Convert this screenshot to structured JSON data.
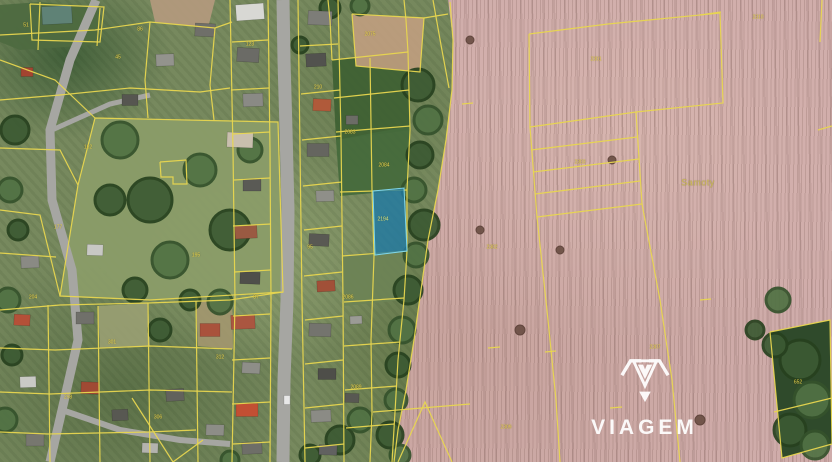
{
  "brand": {
    "name": "VIAGEM"
  },
  "map": {
    "type": "cadastral-aerial",
    "line_color": "#e8d64f",
    "road_color": "#a6a6a2",
    "field_area_label": "Samoty",
    "highlighted_parcel": {
      "label": "2194",
      "points": "373,191 404,188 407,251 375,255",
      "fill": "#1e7aa6",
      "fill_opacity": 0.78,
      "stroke": "#7fd6ea"
    },
    "labels": [
      {
        "x": 140,
        "y": 30,
        "t": "86"
      },
      {
        "x": 250,
        "y": 45,
        "t": "123"
      },
      {
        "x": 318,
        "y": 88,
        "t": "210"
      },
      {
        "x": 196,
        "y": 256,
        "t": "195"
      },
      {
        "x": 88,
        "y": 148,
        "t": "162"
      },
      {
        "x": 58,
        "y": 228,
        "t": "177"
      },
      {
        "x": 33,
        "y": 298,
        "t": "204"
      },
      {
        "x": 112,
        "y": 343,
        "t": "301"
      },
      {
        "x": 68,
        "y": 398,
        "t": "298"
      },
      {
        "x": 158,
        "y": 418,
        "t": "306"
      },
      {
        "x": 220,
        "y": 358,
        "t": "312"
      },
      {
        "x": 256,
        "y": 298,
        "t": "87"
      },
      {
        "x": 310,
        "y": 248,
        "t": "95"
      },
      {
        "x": 350,
        "y": 133,
        "t": "2083"
      },
      {
        "x": 384,
        "y": 166,
        "t": "2084"
      },
      {
        "x": 383,
        "y": 220,
        "t": "2194",
        "cls": "hl"
      },
      {
        "x": 348,
        "y": 298,
        "t": "2086"
      },
      {
        "x": 356,
        "y": 388,
        "t": "2089"
      },
      {
        "x": 596,
        "y": 60,
        "t": "2301"
      },
      {
        "x": 492,
        "y": 248,
        "t": "2302"
      },
      {
        "x": 580,
        "y": 163,
        "t": "2303"
      },
      {
        "x": 758,
        "y": 18,
        "t": "2310"
      },
      {
        "x": 655,
        "y": 348,
        "t": "2307"
      },
      {
        "x": 506,
        "y": 428,
        "t": "2309"
      },
      {
        "x": 798,
        "y": 383,
        "t": "652"
      },
      {
        "x": 118,
        "y": 58,
        "t": "45"
      },
      {
        "x": 26,
        "y": 26,
        "t": "51"
      },
      {
        "x": 370,
        "y": 35,
        "t": "2075"
      },
      {
        "x": 698,
        "y": 183,
        "t": "Samoty",
        "cls": "area"
      }
    ],
    "greens": [
      {
        "p": "95,118 278,122 283,292 150,300 60,296 78,185",
        "c": "#8a9c68"
      },
      {
        "p": "0,5 40,2 100,8 95,45 20,50 0,42",
        "c": "#4e6a40"
      },
      {
        "p": "332,60 408,52 410,130 336,140",
        "c": "#3f6134"
      },
      {
        "p": "336,140 410,126 407,190 340,196",
        "c": "#466a3c"
      },
      {
        "p": "342,256 407,251 404,300 344,306",
        "c": "#6d8355"
      }
    ],
    "dirt": [
      {
        "p": "352,14 424,18 420,72 356,66",
        "c": "#c19f80"
      },
      {
        "p": "150,0 215,0 208,28 155,22",
        "c": "#b59a7e"
      },
      {
        "p": "98,306 148,303 150,346 100,348",
        "c": "#9aa073"
      },
      {
        "p": "196,301 232,300 233,349 198,346",
        "c": "#a3976f"
      }
    ],
    "forest": [
      {
        "p": "770,332 830,320 832,444 782,458",
        "c": "#2f4a2b"
      }
    ],
    "roads": [
      {
        "p": "283,0 284,60 286,130 288,210 287,300 284,380 283,462",
        "w": 13
      },
      {
        "p": "96,0 70,60 50,130 52,200 72,270 78,340 62,410 50,462",
        "w": 9
      },
      {
        "p": "52,130 110,104 150,95",
        "w": 5
      },
      {
        "p": "62,410 120,430 180,440 230,444",
        "w": 6
      }
    ],
    "trees": [
      [
        418,
        85,
        16,
        0
      ],
      [
        428,
        120,
        14,
        1
      ],
      [
        420,
        155,
        13,
        0
      ],
      [
        414,
        190,
        12,
        1
      ],
      [
        424,
        225,
        15,
        0
      ],
      [
        416,
        255,
        12,
        1
      ],
      [
        408,
        290,
        14,
        0
      ],
      [
        402,
        330,
        13,
        1
      ],
      [
        398,
        365,
        12,
        0
      ],
      [
        396,
        400,
        11,
        1
      ],
      [
        390,
        435,
        13,
        0
      ],
      [
        400,
        455,
        10,
        1
      ],
      [
        330,
        8,
        10,
        0
      ],
      [
        360,
        6,
        9,
        1
      ],
      [
        300,
        45,
        8,
        0
      ],
      [
        120,
        140,
        18,
        1
      ],
      [
        150,
        200,
        22,
        0
      ],
      [
        200,
        170,
        16,
        1
      ],
      [
        230,
        230,
        20,
        0
      ],
      [
        170,
        260,
        18,
        1
      ],
      [
        110,
        200,
        15,
        0
      ],
      [
        250,
        150,
        12,
        1
      ],
      [
        135,
        290,
        12,
        0
      ],
      [
        15,
        130,
        14,
        0
      ],
      [
        10,
        190,
        12,
        1
      ],
      [
        18,
        230,
        10,
        0
      ],
      [
        8,
        300,
        12,
        1
      ],
      [
        12,
        355,
        10,
        0
      ],
      [
        5,
        420,
        12,
        1
      ],
      [
        340,
        440,
        14,
        0
      ],
      [
        360,
        420,
        12,
        1
      ],
      [
        310,
        455,
        10,
        0
      ],
      [
        230,
        460,
        9,
        1
      ],
      [
        190,
        300,
        10,
        0
      ],
      [
        220,
        302,
        12,
        1
      ],
      [
        160,
        330,
        11,
        0
      ],
      [
        800,
        360,
        20,
        0
      ],
      [
        812,
        400,
        18,
        1
      ],
      [
        790,
        430,
        16,
        0
      ],
      [
        815,
        445,
        14,
        1
      ],
      [
        775,
        345,
        12,
        0
      ],
      [
        778,
        300,
        12,
        1
      ],
      [
        755,
        330,
        9,
        0
      ],
      [
        470,
        40,
        4,
        3
      ],
      [
        520,
        330,
        5,
        3
      ],
      [
        560,
        250,
        4,
        3
      ],
      [
        612,
        160,
        4,
        3
      ],
      [
        700,
        420,
        5,
        3
      ],
      [
        480,
        230,
        4,
        3
      ]
    ],
    "houses": [
      [
        250,
        12,
        28,
        16,
        -4,
        "#d8d8d4"
      ],
      [
        248,
        55,
        22,
        14,
        3,
        "#6b6b66"
      ],
      [
        253,
        100,
        20,
        13,
        -2,
        "#8a8a85"
      ],
      [
        240,
        140,
        26,
        15,
        2,
        "#c9bfae"
      ],
      [
        252,
        185,
        18,
        12,
        0,
        "#5a5a55"
      ],
      [
        246,
        232,
        22,
        13,
        -3,
        "#9a5a42"
      ],
      [
        250,
        278,
        20,
        12,
        2,
        "#4f4f4a"
      ],
      [
        243,
        322,
        24,
        14,
        -2,
        "#aa5640"
      ],
      [
        251,
        368,
        18,
        11,
        3,
        "#8e8e88"
      ],
      [
        247,
        410,
        22,
        13,
        0,
        "#c24f33"
      ],
      [
        252,
        448,
        20,
        12,
        -2,
        "#6e6e68"
      ],
      [
        320,
        18,
        24,
        14,
        2,
        "#7d7d78"
      ],
      [
        316,
        60,
        20,
        13,
        -3,
        "#52524e"
      ],
      [
        322,
        105,
        18,
        12,
        2,
        "#b05a3a"
      ],
      [
        318,
        150,
        22,
        13,
        0,
        "#65655f"
      ],
      [
        325,
        196,
        18,
        11,
        -2,
        "#8f8f89"
      ],
      [
        319,
        240,
        20,
        12,
        3,
        "#595953"
      ],
      [
        326,
        286,
        18,
        11,
        -3,
        "#a15038"
      ],
      [
        320,
        330,
        22,
        13,
        2,
        "#74746e"
      ],
      [
        327,
        374,
        18,
        11,
        0,
        "#4e4e49"
      ],
      [
        321,
        416,
        20,
        12,
        -2,
        "#8b8b85"
      ],
      [
        328,
        450,
        18,
        10,
        2,
        "#616160"
      ],
      [
        57,
        15,
        30,
        18,
        -3,
        "#5f8276"
      ],
      [
        27,
        72,
        12,
        9,
        0,
        "#a34430"
      ],
      [
        95,
        250,
        16,
        11,
        2,
        "#c8c8c4"
      ],
      [
        30,
        262,
        18,
        12,
        -2,
        "#8a8a84"
      ],
      [
        22,
        320,
        16,
        11,
        3,
        "#b55038"
      ],
      [
        85,
        318,
        18,
        12,
        0,
        "#70706a"
      ],
      [
        28,
        382,
        16,
        11,
        -2,
        "#c9c9c5"
      ],
      [
        90,
        388,
        18,
        12,
        2,
        "#a04a34"
      ],
      [
        35,
        440,
        18,
        12,
        0,
        "#77776f"
      ],
      [
        120,
        415,
        16,
        11,
        -3,
        "#585852"
      ],
      [
        150,
        448,
        16,
        10,
        2,
        "#b3b3ae"
      ],
      [
        205,
        30,
        20,
        13,
        3,
        "#6f6f69"
      ],
      [
        165,
        60,
        18,
        12,
        -2,
        "#93938d"
      ],
      [
        210,
        330,
        20,
        13,
        0,
        "#a9523c"
      ],
      [
        175,
        395,
        18,
        12,
        -3,
        "#62625c"
      ],
      [
        215,
        430,
        18,
        11,
        2,
        "#8d8d87"
      ],
      [
        130,
        100,
        16,
        11,
        0,
        "#565650"
      ],
      [
        352,
        120,
        12,
        9,
        0,
        "#6c6c66"
      ],
      [
        356,
        320,
        12,
        8,
        -2,
        "#9b9b95"
      ],
      [
        352,
        398,
        14,
        9,
        2,
        "#585852"
      ],
      [
        287,
        400,
        6,
        9,
        0,
        "#e8e8e8"
      ]
    ],
    "lines": [
      "0,35 95,30 150,22 215,28 232,22",
      "40,2 38,50",
      "100,8 97,46",
      "30,4 104,7 100,42 32,40 30,4",
      "0,60 55,80 95,118",
      "150,22 145,80 148,118",
      "215,28 210,85 214,120",
      "0,100 60,95 130,88 200,92 230,88",
      "95,118 278,122 283,292 150,300 60,296 78,185 95,118",
      "160,162 186,160 187,184 173,184 173,177 161,177 160,162",
      "0,148 60,150 78,185",
      "0,210 40,215 60,296",
      "0,253 56,257",
      "0,310 60,305 148,303 230,300 283,292",
      "0,348 55,350 150,346 232,349",
      "0,392 50,394 150,390 232,392",
      "0,432 48,434 148,432 196,430",
      "48,305 50,462",
      "98,306 100,462",
      "148,303 150,462",
      "196,301 198,462",
      "230,0 233,150 235,300 232,462",
      "268,0 270,150 271,300 270,462",
      "298,0 300,150 302,300 305,462",
      "338,0 341,136 343,300 344,462",
      "370,58 372,190 374,256 371,340 372,412 370,462",
      "408,52 410,130 407,190 407,251 404,300 398,360 395,412 392,462",
      "232,42 268,40",
      "231,90 269,88",
      "233,134 270,132",
      "234,180 270,178",
      "233,226 271,224",
      "234,272 271,270",
      "233,316 270,314",
      "232,360 270,358",
      "232,404 270,402",
      "233,444 270,442",
      "300,46 338,44",
      "301,94 340,90",
      "302,140 341,136",
      "303,186 342,182",
      "304,230 342,226",
      "304,276 342,272",
      "305,320 343,316",
      "305,364 343,360",
      "305,408 344,404",
      "305,448 344,444",
      "332,60 408,52",
      "334,98 409,90",
      "336,132 410,126",
      "340,192 407,190",
      "342,256 407,251",
      "344,302 404,298",
      "344,346 400,342",
      "345,390 397,386",
      "346,428 394,424",
      "352,14 424,18 420,72 356,66 352,14",
      "328,0 330,20 332,60",
      "404,0 406,20 408,52",
      "424,18 448,14",
      "373,412 470,404",
      "398,462 425,402 452,462",
      "132,398 173,462",
      "173,462 203,440",
      "450,2 453,40 452,90 446,140 438,190 428,240 421,290 414,340 406,390 398,430 394,462",
      "433,0 441,45 449,88",
      "529,34 608,24 720,13 723,103 636,112 530,127 529,34",
      "531,150 637,137",
      "533,172 639,159",
      "535,194 640,181",
      "537,217 642,204",
      "636,112 642,204",
      "530,127 537,217 548,320 556,400 560,462",
      "642,204 660,300 672,380 680,462",
      "700,15 721,12",
      "818,130 832,126",
      "822,0 820,42",
      "770,332 830,320 832,444 782,458 770,332",
      "774,412 832,398",
      "488,348 500,347",
      "545,352 556,351",
      "462,104 473,103",
      "610,408 622,407",
      "700,300 711,299"
    ]
  }
}
